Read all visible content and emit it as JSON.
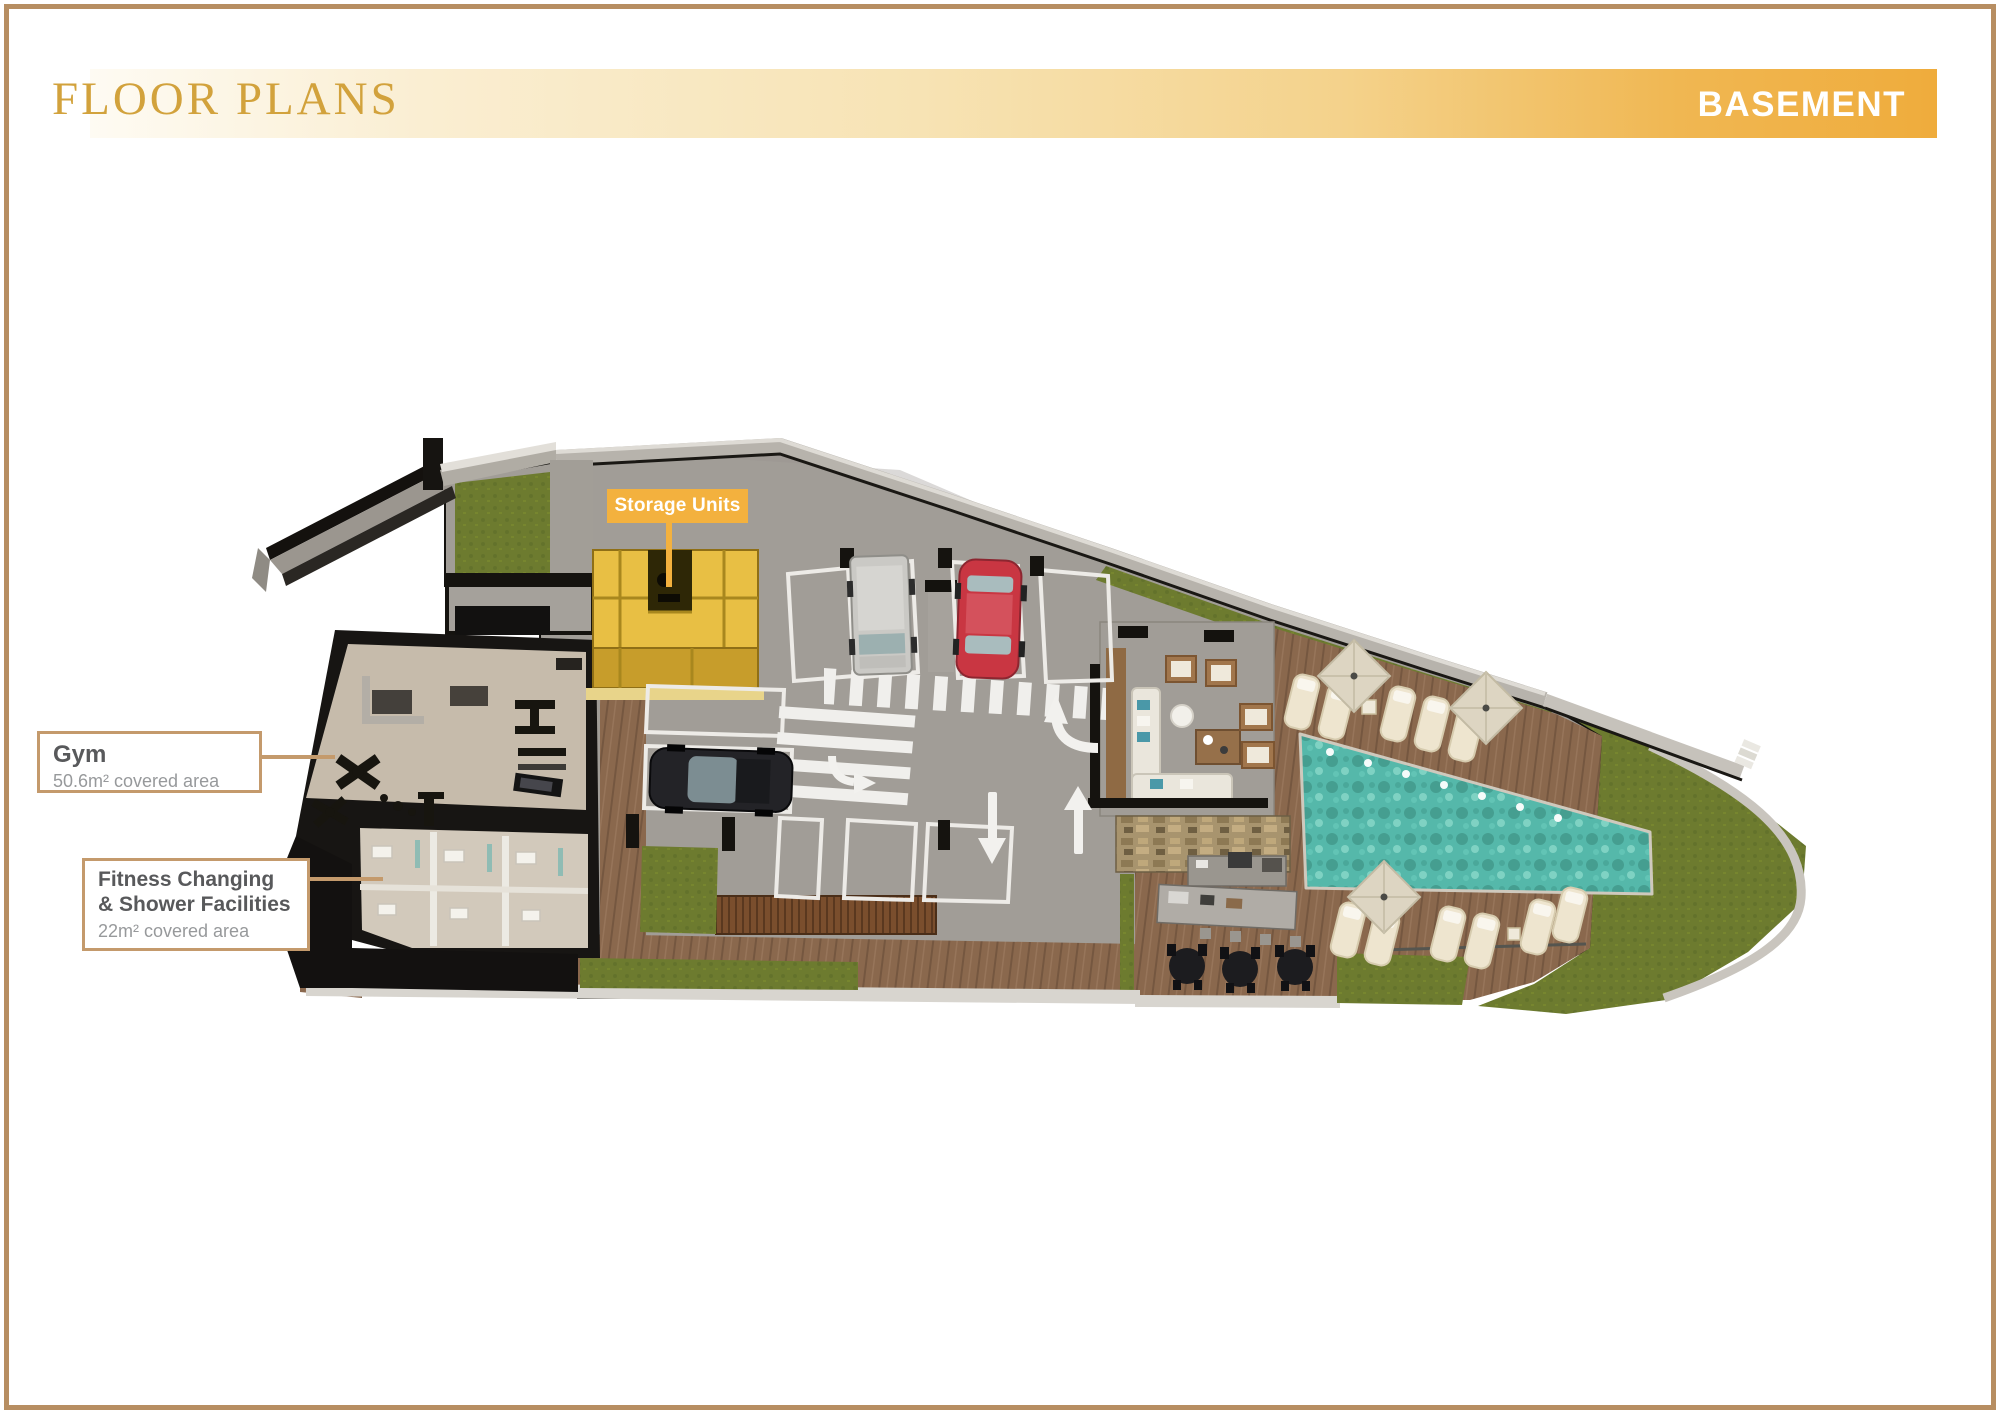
{
  "page": {
    "background": "#ffffff",
    "border_color": "#b78e62"
  },
  "header": {
    "title": "FLOOR PLANS",
    "floor_label": "BASEMENT",
    "title_color": "#d2a23c",
    "band_start_color": "#fefbf3",
    "band_end_color": "#efac3c"
  },
  "callouts": {
    "storage": {
      "label": "Storage Units",
      "bg_color": "#f3b13e",
      "text_color": "#ffffff"
    },
    "gym": {
      "title": "Gym",
      "subtitle": "50.6m² covered area"
    },
    "fitness": {
      "title_line1": "Fitness Changing",
      "title_line2": "& Shower Facilities",
      "subtitle": "22m² covered area"
    },
    "border_color": "#c49a6c",
    "title_text_color": "#58595b",
    "subtitle_text_color": "#97999b"
  },
  "plan_palette": {
    "concrete": "#a19d97",
    "grass": "#6d7b2f",
    "wood_deck": "#8a684d",
    "pool_water": "#55b8aa",
    "storage_highlight": "#e8bf44",
    "perimeter_wall": "#b7b3ac",
    "room_floor": "#c6bbab",
    "marking_white": "#edebe7"
  }
}
